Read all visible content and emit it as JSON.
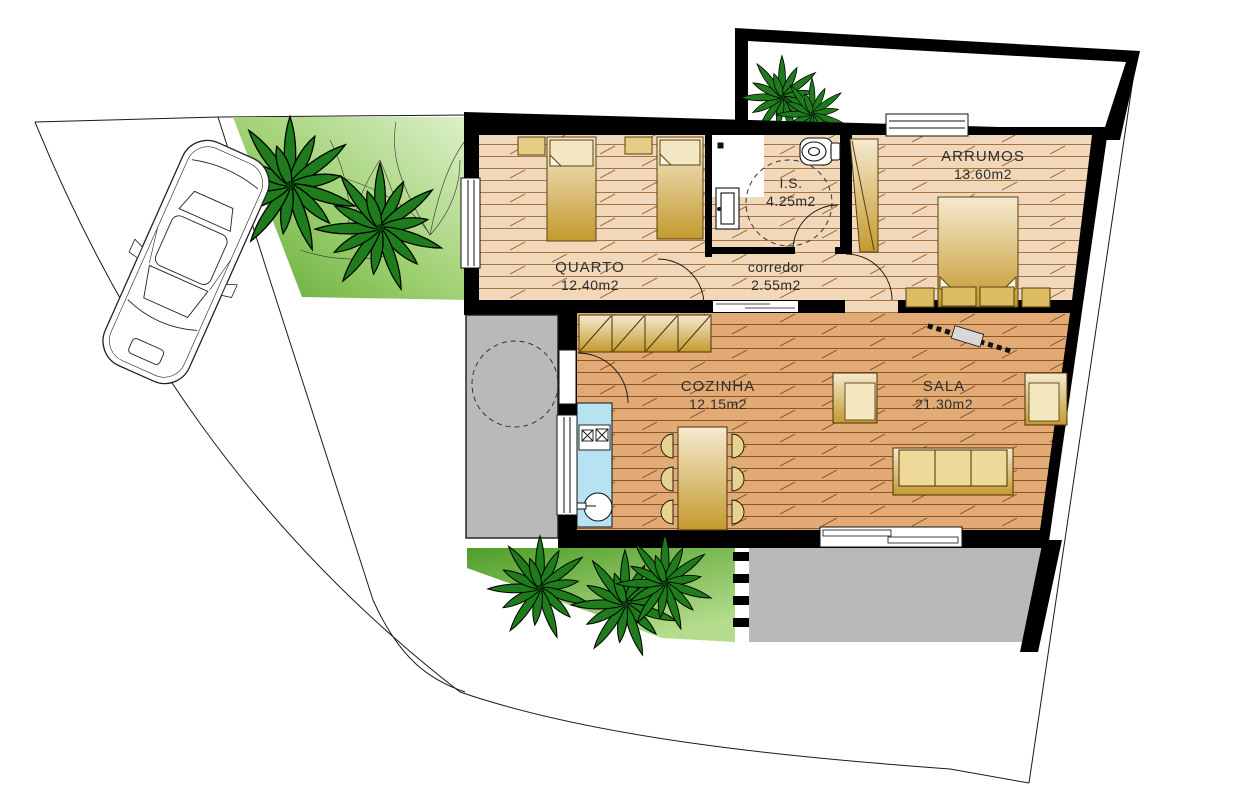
{
  "rooms": [
    {
      "id": "quarto",
      "name": "QUARTO",
      "area": "12.40m2"
    },
    {
      "id": "corredor",
      "name": "corredor",
      "area": "2.55m2"
    },
    {
      "id": "is",
      "name": "I.S.",
      "area": "4.25m2"
    },
    {
      "id": "arrumos",
      "name": "ARRUMOS",
      "area": "13.60m2"
    },
    {
      "id": "cozinha",
      "name": "COZINHA",
      "area": "12.15m2"
    },
    {
      "id": "sala",
      "name": "SALA",
      "area": "21.30m2"
    }
  ],
  "palette": {
    "wall": "#000000",
    "floor_light": "#f1d8bb",
    "floor_dark": "#e2ab76",
    "furniture_gold_light": "#f5ead0",
    "furniture_gold_dark": "#c49a2e",
    "counter_blue": "#b7e2f2",
    "patio_gray": "#b9b9b9",
    "grass_dark": "#4f9e28",
    "grass_light": "#cdeab0",
    "palm_green": "#1e7c1c"
  }
}
